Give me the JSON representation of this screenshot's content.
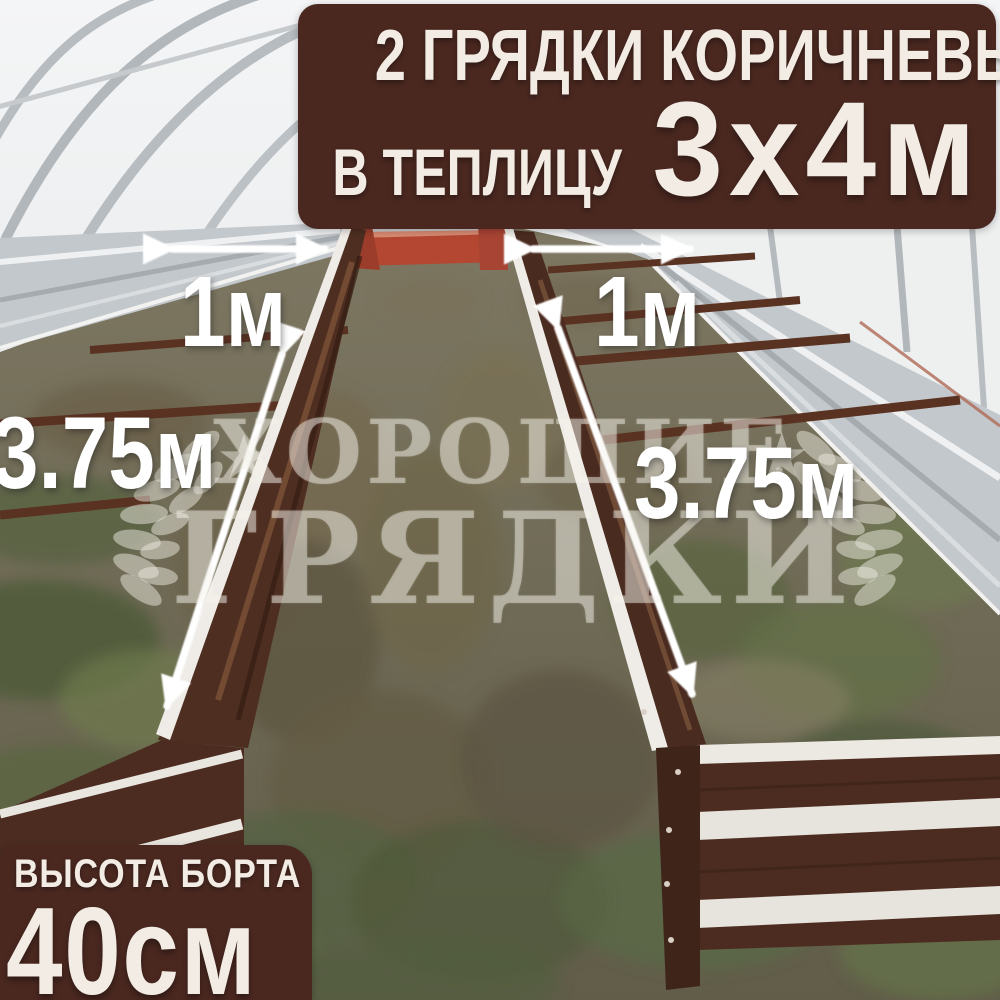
{
  "top_banner": {
    "line1": "2 ГРЯДКИ КОРИЧНЕВЫЕ",
    "line2_prefix": "В ТЕПЛИЦУ",
    "line2_size": "3х4м"
  },
  "bottom_banner": {
    "label": "ВЫСОТА БОРТА",
    "value": "40см"
  },
  "dimensions": {
    "left_bed_width": "1м",
    "right_bed_width": "1м",
    "left_bed_length": "3.75м",
    "right_bed_length": "3.75м"
  },
  "watermark": {
    "line1": "ХОРОШИЕ",
    "line2": "ГРЯДКИ",
    "star_icon": "★"
  },
  "colors": {
    "banner_brown": "#4a2820",
    "banner_text_cream": "#f2ece4",
    "bed_brown": "#4e2e21",
    "bed_rim_white": "#efece7",
    "galvanized_silver": "#c3c8cc",
    "accent_red_panel": "#b44731",
    "ground_green": "#5a6642",
    "arrow_white": "#ffffff"
  }
}
